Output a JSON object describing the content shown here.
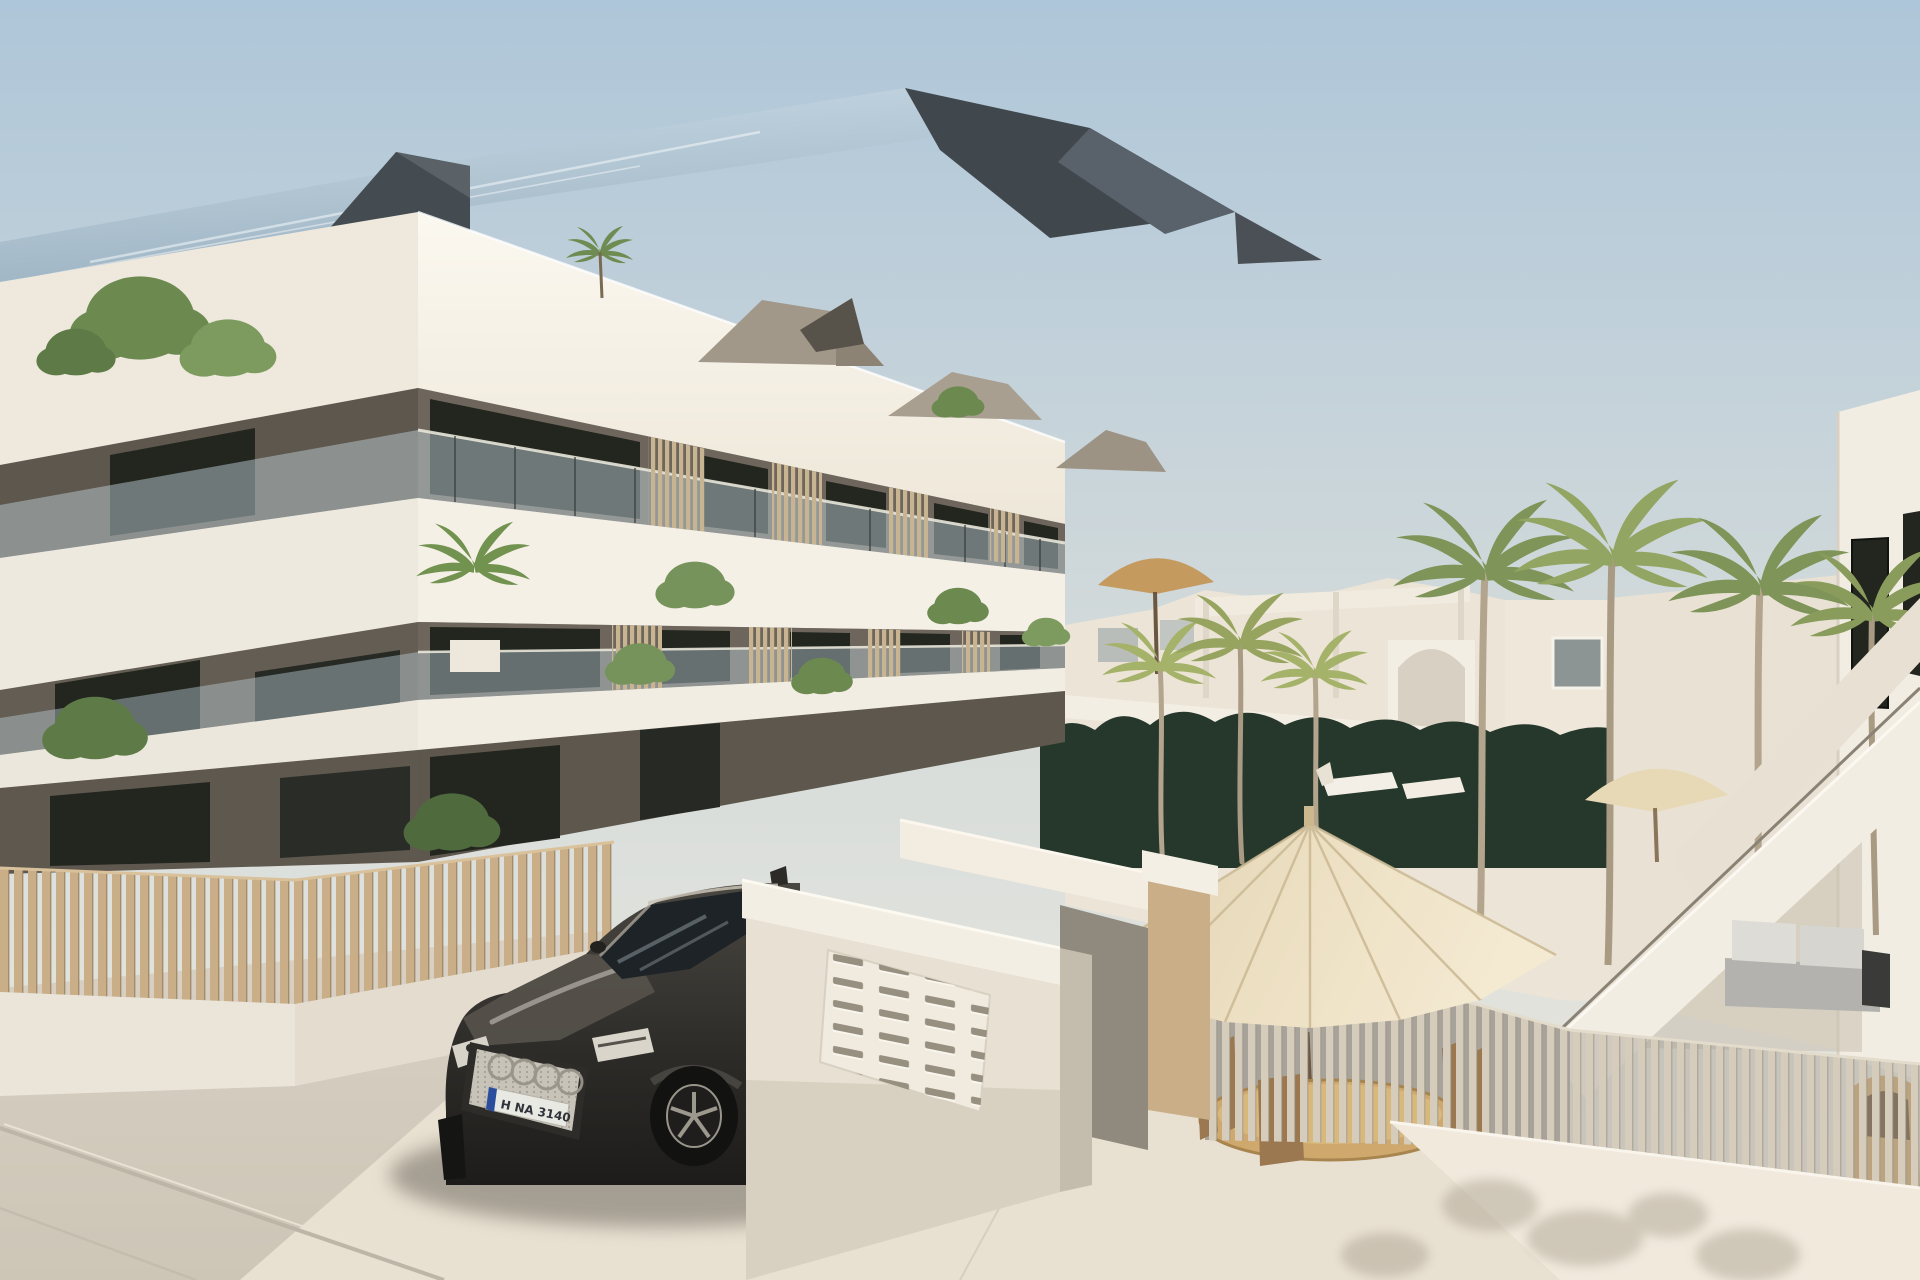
{
  "scene": {
    "description": "Sunny 3D architectural rendering: modern three-storey white apartment building with glass balconies and wood slat screens, palm trees, courtyard with cream patio umbrella and rattan dining set, slatted privacy fences, white entrance wall with mailbox grid, exterior staircase on right building, dark SUV parked at the entrance",
    "time_of_day": "daylight"
  },
  "car": {
    "type": "dark SUV",
    "brand_mark": "four-rings",
    "license_plate": "H NA 3140"
  },
  "colors": {
    "sky_top": "#aec6d9",
    "sky_horizon": "#ece8df",
    "roof_glass_top": "#c9dae6",
    "roof_glass_bottom": "#9db3c2",
    "roof_dark": "#41484d",
    "fascia_front": "#f8f4eb",
    "fascia_left": "#efe9dd",
    "slab_white": "#f4f0e6",
    "wall_dark": "#6e665c",
    "wall_dark_shadow": "#5e574d",
    "glass_tint": "#b9cad2",
    "window_dark": "#22261f",
    "fence_slat": "#c9ae87",
    "fence_slat_light": "#d5ccbc",
    "screen_slat": "#c9b491",
    "fence_base": "#ebe5d9",
    "hedge": "#26382c",
    "palm_frond": "#7f9458",
    "palm_frond_light": "#a5b269",
    "palm_trunk": "#b3a48d",
    "bush_green": "#6c8a50",
    "umbrella_cream": "#ecdfc2",
    "umbrella_tan": "#c59a5f",
    "paving": "#d8d1c4",
    "paving_sun": "#e8e0d1",
    "courtyard_shade": "#a8a39a",
    "car_top": "#4a4741",
    "car_dark": "#1d1c1a",
    "car_glass": "#1e2327",
    "grille_silver": "#c8c3b9",
    "rim_silver": "#98948a",
    "plate_blue": "#2b4d9e",
    "sofa_gray": "#b3b2ae",
    "sofa_cushion": "#dddcd6",
    "table_rattan": "#cfa86e",
    "chair_wood": "#9b7850",
    "right_building": "#f2ede3",
    "background_wall": "#ece4d6",
    "entrance_white": "#f3eee4",
    "shadow_soft": "#6f695e"
  }
}
